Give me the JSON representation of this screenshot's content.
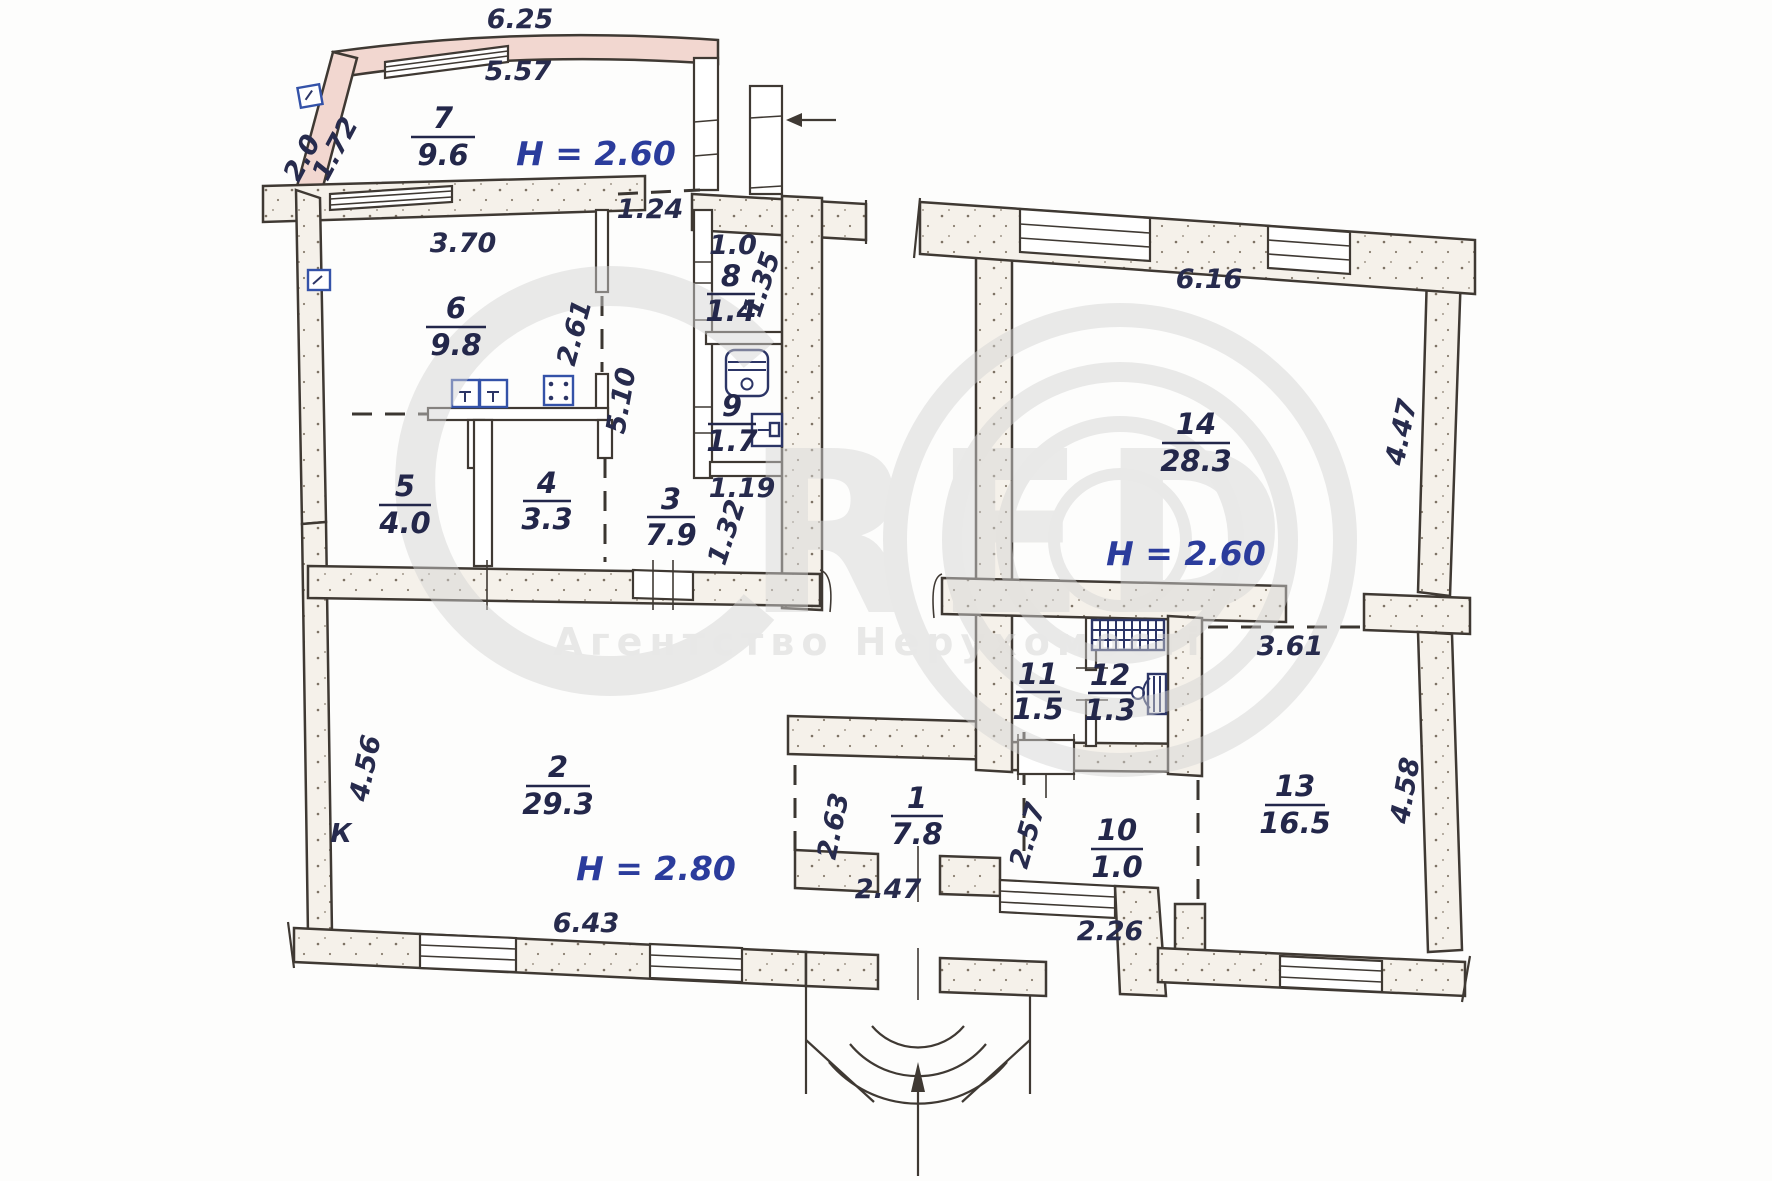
{
  "watermark": {
    "letters_red": "RED",
    "agency": "Агентство Нерухомості"
  },
  "rooms": [
    {
      "number": "7",
      "area": "9.6"
    },
    {
      "number": "6",
      "area": "9.8"
    },
    {
      "number": "8",
      "area": "1.4"
    },
    {
      "number": "9",
      "area": "1.7"
    },
    {
      "number": "5",
      "area": "4.0"
    },
    {
      "number": "4",
      "area": "3.3"
    },
    {
      "number": "3",
      "area": "7.9"
    },
    {
      "number": "14",
      "area": "28.3"
    },
    {
      "number": "11",
      "area": "1.5"
    },
    {
      "number": "12",
      "area": "1.3"
    },
    {
      "number": "2",
      "area": "29.3"
    },
    {
      "number": "1",
      "area": "7.8"
    },
    {
      "number": "10",
      "area": "1.0"
    },
    {
      "number": "13",
      "area": "16.5"
    }
  ],
  "heights": {
    "room7": "H = 2.60",
    "room14": "H = 2.60",
    "room2": "H = 2.80"
  },
  "dimensions": {
    "top_outer": "6.25",
    "top_inner": "5.57",
    "bay_left": "2.0",
    "bay_left2": "1.72",
    "room6_top": "3.70",
    "door_124": "1.24",
    "room8_top": "1.0",
    "room8_side": "1.35",
    "kitchen_dash": "2.61",
    "kitchen_dash2": "5.10",
    "room9_bottom": "1.19",
    "hall_opening": "1.32",
    "room14_top": "6.16",
    "room14_right": "4.47",
    "room13_top": "3.61",
    "room13_right": "4.58",
    "room2_left": "4.56",
    "room2_bottom": "6.43",
    "room1_left": "2.63",
    "entrance_door": "2.47",
    "room1_right": "2.57",
    "room10_bottom": "2.26"
  },
  "annotations": {
    "left_mark": "К"
  }
}
